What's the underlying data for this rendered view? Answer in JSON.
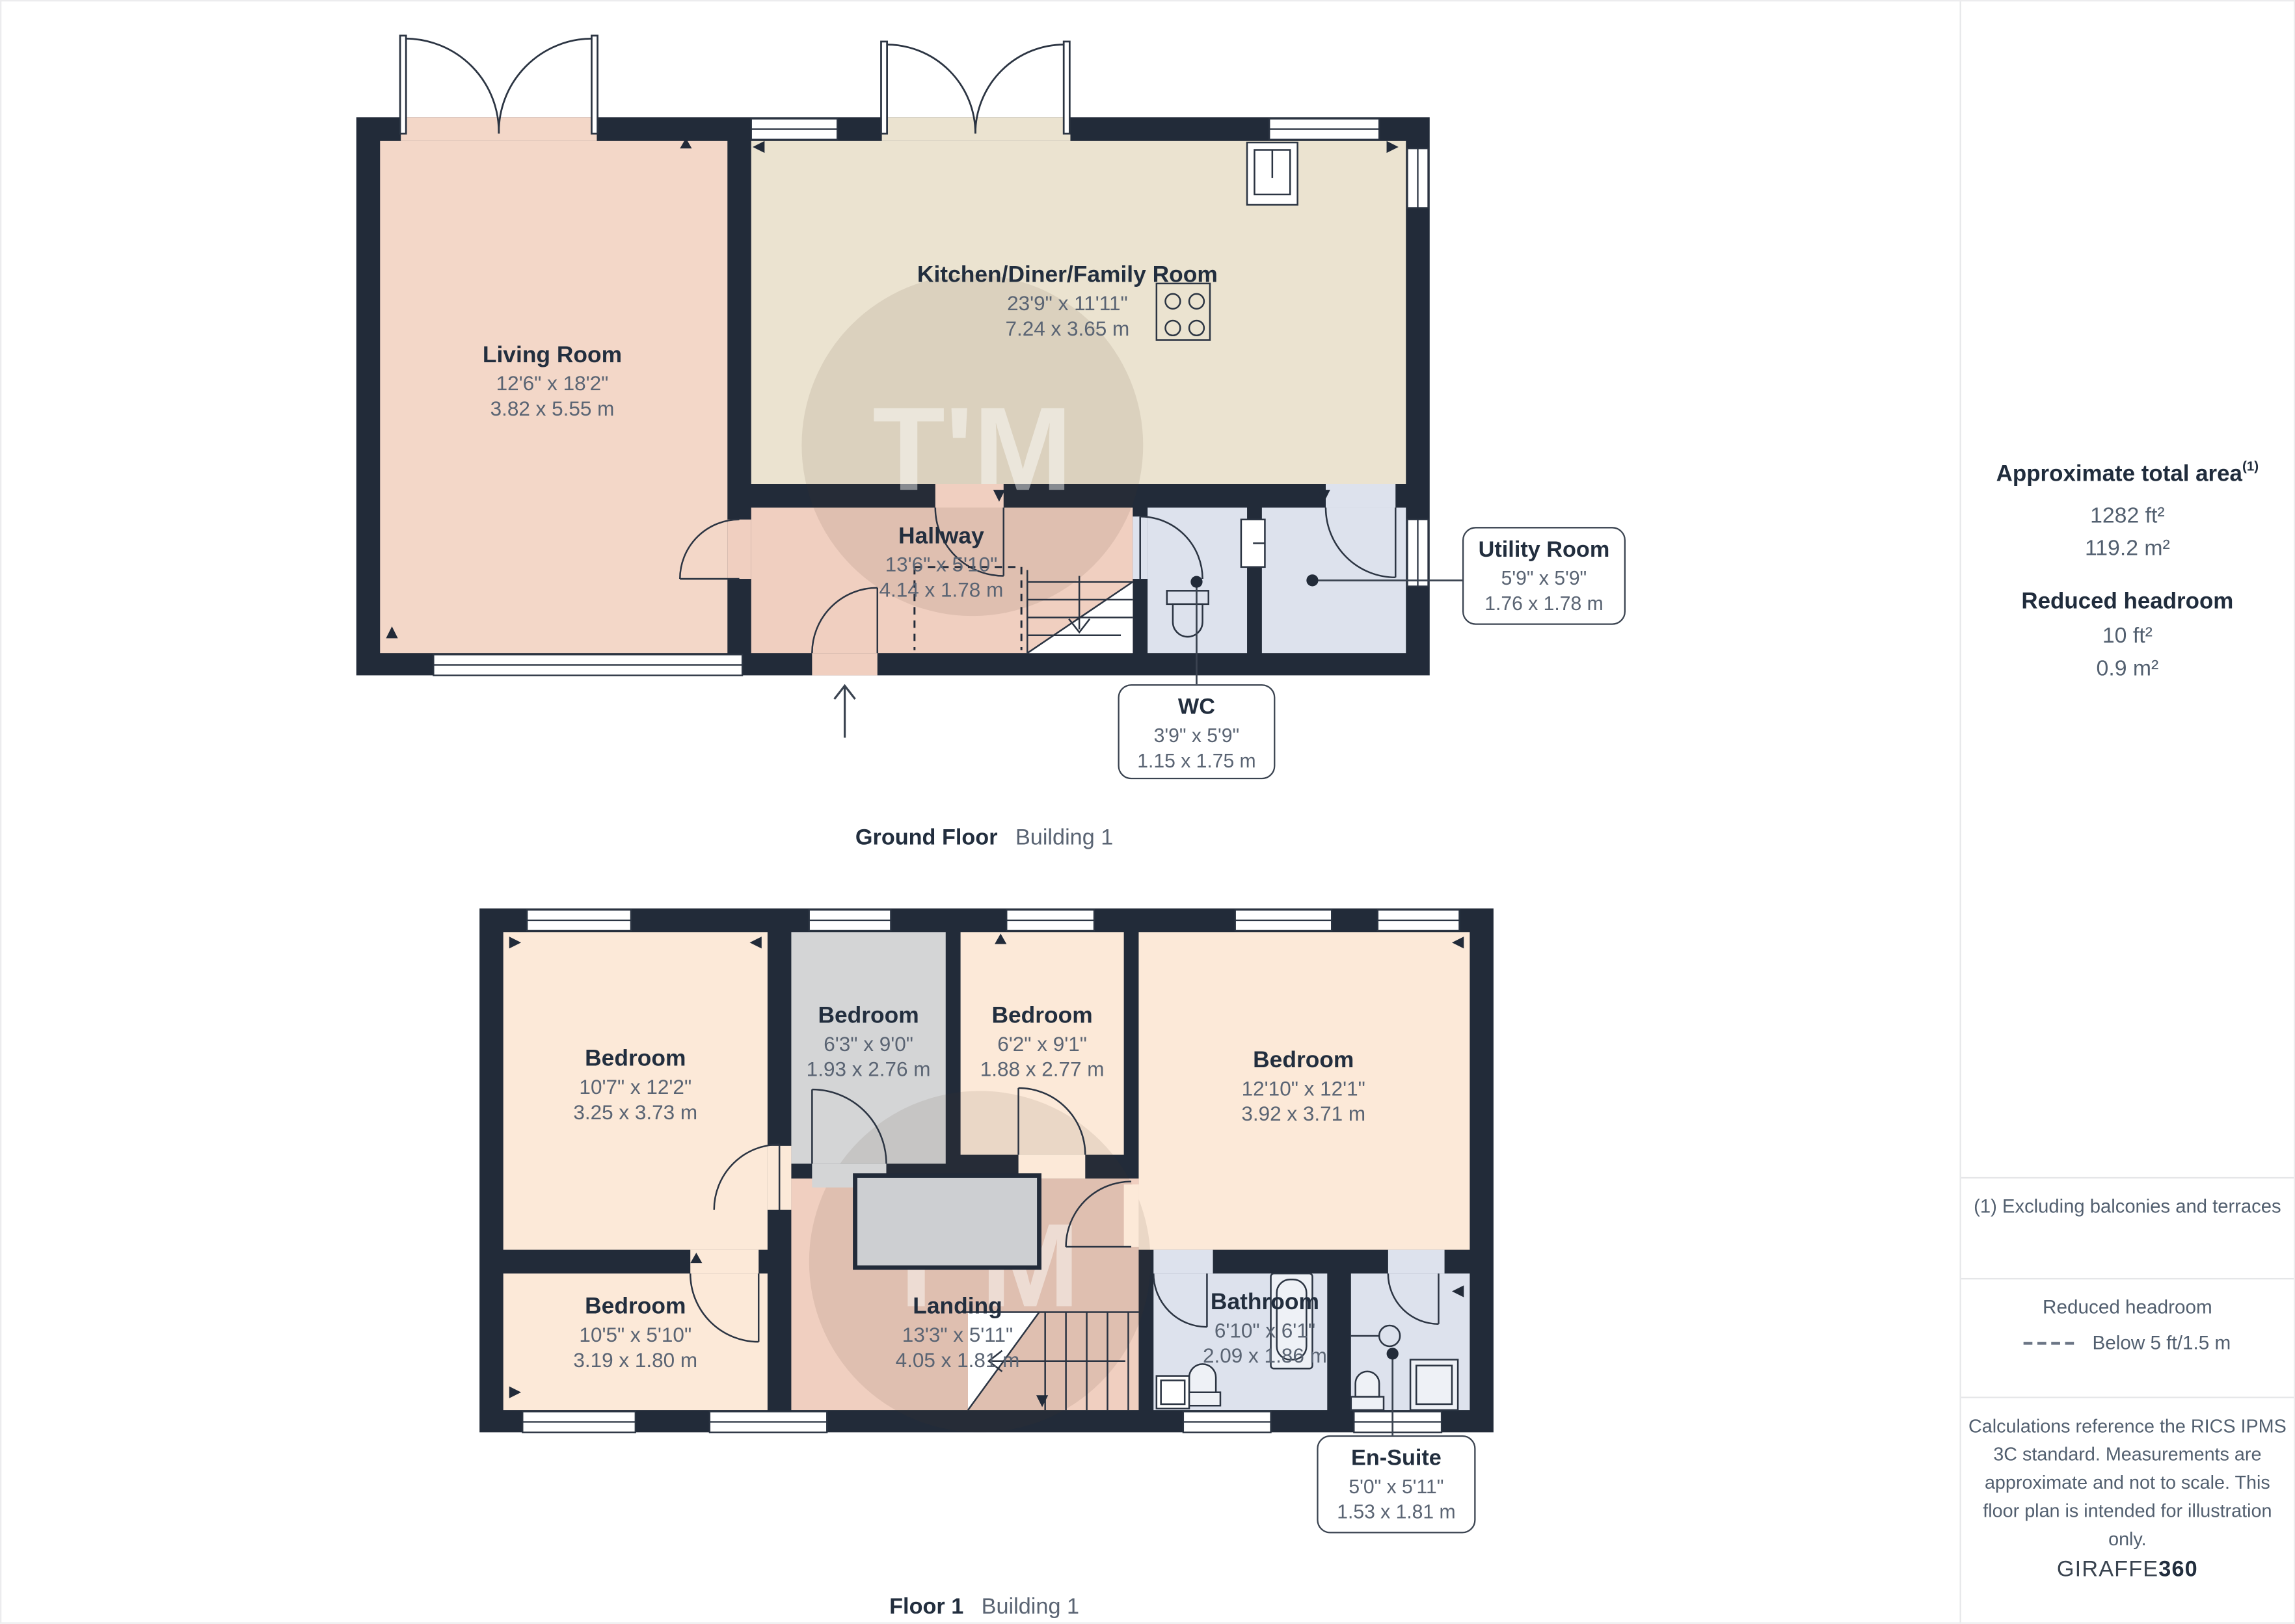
{
  "palette": {
    "wall": "#222b39",
    "living": "#f3d7c8",
    "kitchen": "#ebe3d0",
    "hallway": "#f0cfc0",
    "bedroom": "#fce9d8",
    "bedroom_gray": "#d4d5d6",
    "wet_room": "#dde2ed",
    "title_text": "#222e3e",
    "dim_text": "#5a6473"
  },
  "watermark": {
    "text": "T'M"
  },
  "ground_floor": {
    "caption_bold": "Ground Floor",
    "caption_light": "Building 1",
    "rooms": [
      {
        "name": "Living Room",
        "imperial": "12'6\" x 18'2\"",
        "metric": "3.82 x 5.55 m"
      },
      {
        "name": "Kitchen/Diner/Family Room",
        "imperial": "23'9\" x 11'11\"",
        "metric": "7.24 x 3.65 m"
      },
      {
        "name": "Hallway",
        "imperial": "13'6\" x 5'10\"",
        "metric": "4.14 x 1.78 m"
      }
    ],
    "callouts": [
      {
        "name": "WC",
        "imperial": "3'9\" x 5'9\"",
        "metric": "1.15 x 1.75 m"
      },
      {
        "name": "Utility Room",
        "imperial": "5'9\" x 5'9\"",
        "metric": "1.76 x 1.78 m"
      }
    ]
  },
  "floor1": {
    "caption_bold": "Floor 1",
    "caption_light": "Building 1",
    "rooms": [
      {
        "name": "Bedroom",
        "imperial": "10'7\" x 12'2\"",
        "metric": "3.25 x 3.73 m"
      },
      {
        "name": "Bedroom",
        "imperial": "6'3\" x 9'0\"",
        "metric": "1.93 x 2.76 m"
      },
      {
        "name": "Bedroom",
        "imperial": "6'2\" x 9'1\"",
        "metric": "1.88 x 2.77 m"
      },
      {
        "name": "Bedroom",
        "imperial": "12'10\" x 12'1\"",
        "metric": "3.92 x 3.71 m"
      },
      {
        "name": "Bedroom",
        "imperial": "10'5\" x 5'10\"",
        "metric": "3.19 x 1.80 m"
      },
      {
        "name": "Landing",
        "imperial": "13'3\" x 5'11\"",
        "metric": "4.05 x 1.81 m"
      },
      {
        "name": "Bathroom",
        "imperial": "6'10\" x 6'1\"",
        "metric": "2.09 x 1.86 m"
      }
    ],
    "callouts": [
      {
        "name": "En-Suite",
        "imperial": "5'0\" x 5'11\"",
        "metric": "1.53 x 1.81 m"
      }
    ]
  },
  "sidebar": {
    "total_area_title": "Approximate total area",
    "total_area_sup": "(1)",
    "total_area_ft": "1282 ft²",
    "total_area_m": "119.2 m²",
    "reduced_headroom_title": "Reduced headroom",
    "reduced_headroom_ft": "10 ft²",
    "reduced_headroom_m": "0.9 m²",
    "footnote": "(1) Excluding balconies and terraces",
    "legend_title": "Reduced headroom",
    "legend_label": "Below 5 ft/1.5 m",
    "disclaimer": "Calculations reference the RICS IPMS 3C standard. Measurements are approximate and not to scale. This floor plan is intended for illustration only.",
    "brand_light": "GIRAFFE",
    "brand_bold": "360"
  }
}
